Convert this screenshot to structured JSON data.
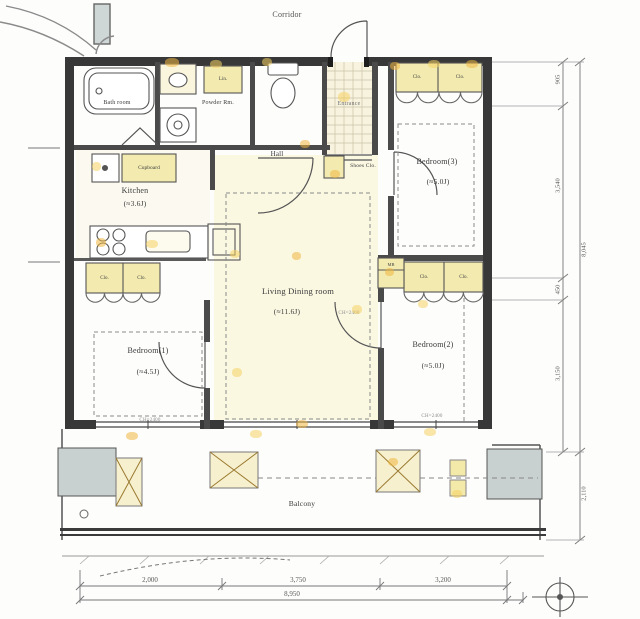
{
  "plan": {
    "corridor": "Corridor",
    "balcony": "Balcony",
    "entrance": "Entrance",
    "hall": "Hall",
    "bath": "Bath room",
    "powder": "Powder Rm.",
    "kitchen": {
      "name": "Kitchen",
      "size": "(≈3.6J)"
    },
    "living": {
      "name": "Living Dining room",
      "size": "(≈11.6J)",
      "ch": "CH=2400"
    },
    "bedroom1": {
      "name": "Bedroom(1)",
      "size": "(≈4.5J)",
      "ch": "CH=2400"
    },
    "bedroom2": {
      "name": "Bedroom(2)",
      "size": "(≈5.0J)",
      "ch": "CH=2400"
    },
    "bedroom3": {
      "name": "Bedroom(3)",
      "size": "(≈5.0J)"
    },
    "cupboard": "Cupboard",
    "shoes": "Shoes Clo.",
    "linen": "Lin.",
    "closet": "Clo.",
    "mb": "MB"
  },
  "dimensions": {
    "bottom": [
      "2,000",
      "3,750",
      "3,200"
    ],
    "bottom_total": "8,950",
    "right": [
      "905",
      "3,540",
      "450",
      "3,150"
    ],
    "right_total": "8,045",
    "balcony_depth": "2,110"
  },
  "colors": {
    "wall": "#383838",
    "room_tint": "#f9f5da",
    "cabinet": "#f2eaae",
    "column": "#c9d0d0",
    "highlight_yellow": "#f5d262",
    "highlight_orange": "#f0b63f"
  }
}
